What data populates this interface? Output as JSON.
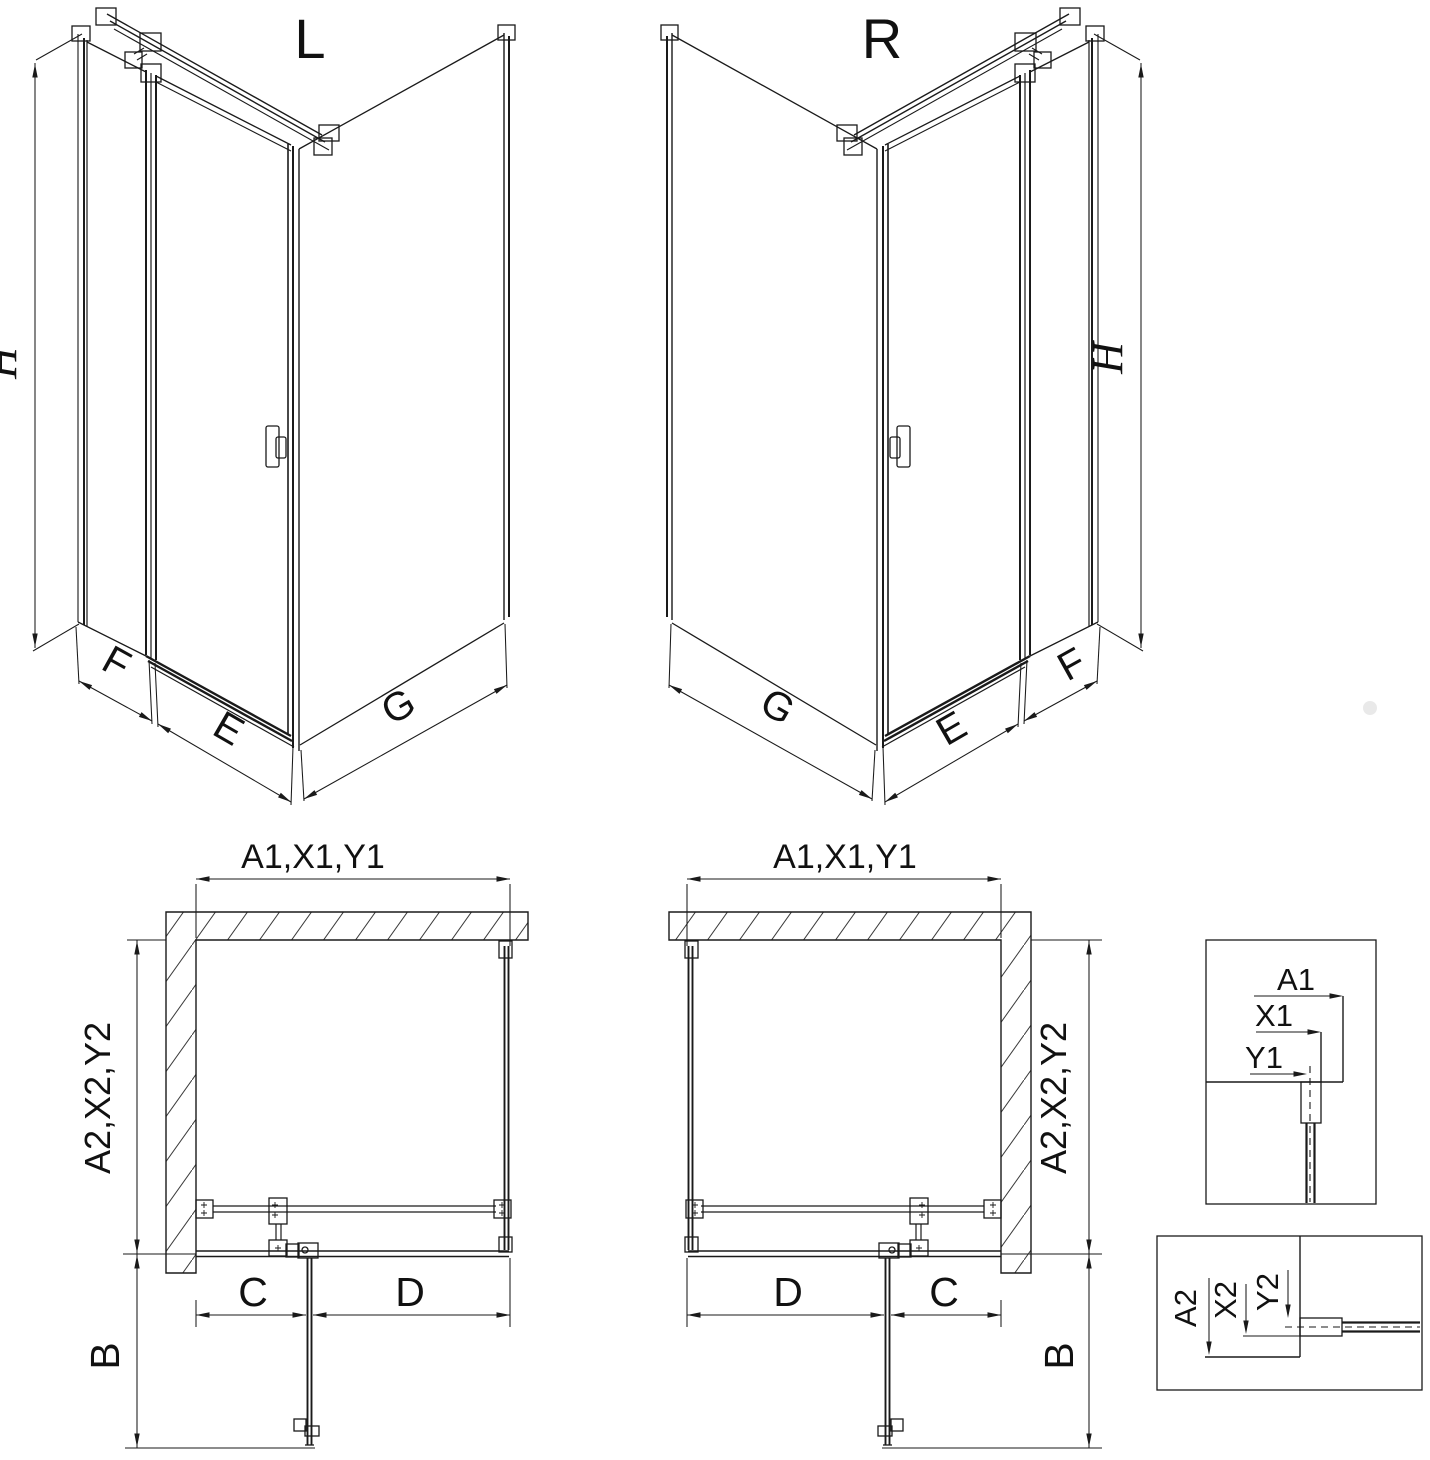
{
  "colors": {
    "line": "#1a1a1a",
    "background": "#ffffff",
    "hatch_line": "#3a3a3a",
    "watermark_dot": "#e3e3e3"
  },
  "left_3d_view": {
    "title": "L",
    "height_dim": "H",
    "side_panel_dim": "F",
    "door_dim": "E",
    "side_wall_dim": "G"
  },
  "right_3d_view": {
    "title": "R",
    "height_dim": "H",
    "side_panel_dim": "F",
    "door_dim": "E",
    "side_wall_dim": "G"
  },
  "left_plan_view": {
    "width_dim": "A1,X1,Y1",
    "depth_dim": "A2,X2,Y2",
    "door_swing_dim": "B",
    "fixed_section_dim": "C",
    "door_section_dim": "D"
  },
  "right_plan_view": {
    "width_dim": "A1,X1,Y1",
    "depth_dim": "A2,X2,Y2",
    "door_swing_dim": "B",
    "fixed_section_dim": "C",
    "door_section_dim": "D"
  },
  "detail_width_box": {
    "dim_a1": "A1",
    "dim_x1": "X1",
    "dim_y1": "Y1"
  },
  "detail_depth_box": {
    "dim_a2": "A2",
    "dim_x2": "X2",
    "dim_y2": "Y2"
  }
}
